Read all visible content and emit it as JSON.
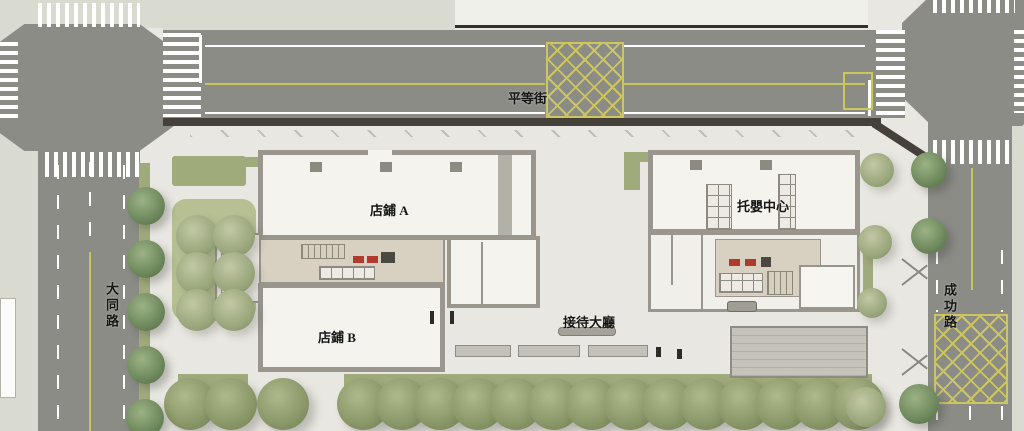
{
  "plan": {
    "type": "architectural-site-plan",
    "streets": {
      "top": "平等街",
      "left": "大同路",
      "right": "成功路"
    },
    "buildings": {
      "shop_a": "店鋪 A",
      "shop_b": "店鋪 B",
      "reception": "接待大廳",
      "daycare": "托嬰中心"
    }
  },
  "colors": {
    "site": "#e9e7e1",
    "road": "#8c8c87",
    "sidewalk": "#d9dbd1",
    "curb": "#45403a",
    "wall": "#9a968d",
    "interior": "#f4f3ee",
    "core": "#d8d1c1",
    "green": "#a0ab7c",
    "cluster_pad": "#b6c092",
    "hatch": "#cdc65f",
    "lane_yellow": "#c6c55e",
    "elevator_red": "#b03a2e",
    "block_white": "#eff0ea"
  },
  "trees": {
    "groups": [
      {
        "name": "street-tree-row-south",
        "variant": "olive",
        "r": 26,
        "points": [
          {
            "x": 190,
            "y": 404
          },
          {
            "x": 231,
            "y": 404
          },
          {
            "x": 283,
            "y": 404
          },
          {
            "x": 363,
            "y": 404
          },
          {
            "x": 402,
            "y": 404
          },
          {
            "x": 440,
            "y": 404
          },
          {
            "x": 478,
            "y": 404
          },
          {
            "x": 516,
            "y": 404
          },
          {
            "x": 554,
            "y": 404
          },
          {
            "x": 592,
            "y": 404
          },
          {
            "x": 630,
            "y": 404
          },
          {
            "x": 668,
            "y": 404
          },
          {
            "x": 706,
            "y": 404
          },
          {
            "x": 744,
            "y": 404
          },
          {
            "x": 782,
            "y": 404
          },
          {
            "x": 820,
            "y": 404
          },
          {
            "x": 858,
            "y": 404
          }
        ]
      },
      {
        "name": "courtyard-tree-cluster",
        "variant": "pale",
        "r": 21,
        "points": [
          {
            "x": 197,
            "y": 236
          },
          {
            "x": 234,
            "y": 236
          },
          {
            "x": 197,
            "y": 273
          },
          {
            "x": 234,
            "y": 273
          },
          {
            "x": 197,
            "y": 310
          },
          {
            "x": 234,
            "y": 310
          }
        ]
      },
      {
        "name": "street-tree-datong",
        "variant": "dark",
        "r": 19,
        "points": [
          {
            "x": 146,
            "y": 206
          },
          {
            "x": 146,
            "y": 259
          },
          {
            "x": 146,
            "y": 312
          },
          {
            "x": 146,
            "y": 365
          },
          {
            "x": 145,
            "y": 418
          }
        ]
      },
      {
        "name": "site-tree-east",
        "variant": "pale",
        "r": 17,
        "points": [
          {
            "x": 877,
            "y": 170
          },
          {
            "x": 875,
            "y": 242
          },
          {
            "x": 872,
            "y": 303,
            "r": 15
          },
          {
            "x": 866,
            "y": 407,
            "r": 20
          }
        ]
      },
      {
        "name": "street-tree-chenggong",
        "variant": "dark",
        "r": 18,
        "points": [
          {
            "x": 929,
            "y": 170
          },
          {
            "x": 929,
            "y": 236
          },
          {
            "x": 919,
            "y": 404,
            "r": 20
          }
        ]
      }
    ]
  }
}
